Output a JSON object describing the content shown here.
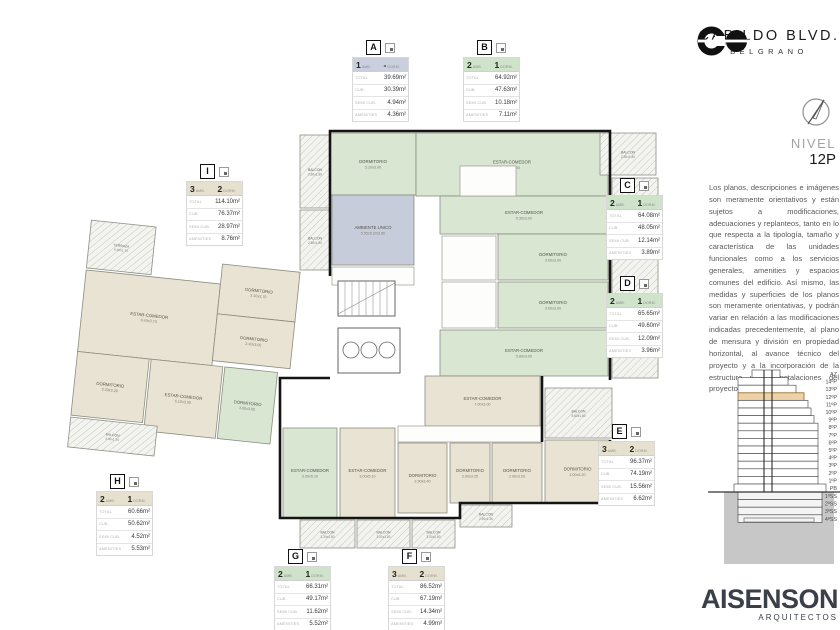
{
  "header": {
    "title": "CABILDO BLVD.",
    "subtitle": "BELGRANO",
    "level_label": "NIVEL",
    "level_value": "12P"
  },
  "disclaimer": "Los planos, descripciones e imágenes son meramente orientativos y están sujetos a modificaciones, adecuaciones y replanteos, tanto en lo que respecta a la tipología, tamaño y característica de las unidades funcionales como a los servicios generales, amenities y espacios comunes del edificio. Así mismo, las medidas y superficies de los planos son meramente orientativas, y podrán variar en relación a las modificaciones indicadas precedentemente, al plano de mensura y división en propiedad horizontal, al avance técnico del proyecto y a la incorporación de la estructura y las instalaciones del proyecto.",
  "architect": {
    "name": "AISENSON",
    "sub": "ARQUITECTOS"
  },
  "colors": {
    "green": "#d9e6d2",
    "beige": "#e8e3d2",
    "blue": "#c7ccdb",
    "header_green": "#cfe2ca",
    "header_beige": "#e6e1cf",
    "header_blue": "#c9cfdd",
    "highlight_floor": "#eed2a6"
  },
  "table_labels": {
    "amb": "AMB.",
    "dorm": "DORM.",
    "rows": [
      "TOTAL",
      "CUB.",
      "SEMI CUB.",
      "AMENITIES"
    ]
  },
  "unit_tables": [
    {
      "letter": "A",
      "amb": "1",
      "dorm": "-",
      "color": "#c9cfdd",
      "values": [
        "39.69m²",
        "30.39m²",
        "4.94m²",
        "4.36m²"
      ]
    },
    {
      "letter": "B",
      "amb": "2",
      "dorm": "1",
      "color": "#cfe2ca",
      "values": [
        "64.92m²",
        "47.63m²",
        "10.18m²",
        "7.11m²"
      ]
    },
    {
      "letter": "C",
      "amb": "2",
      "dorm": "1",
      "color": "#cfe2ca",
      "values": [
        "64.08m²",
        "48.05m²",
        "12.14m²",
        "3.89m²"
      ]
    },
    {
      "letter": "D",
      "amb": "2",
      "dorm": "1",
      "color": "#cfe2ca",
      "values": [
        "65.65m²",
        "49.60m²",
        "12.09m²",
        "3.96m²"
      ]
    },
    {
      "letter": "E",
      "amb": "3",
      "dorm": "2",
      "color": "#e6e1cf",
      "values": [
        "96.37m²",
        "74.19m²",
        "15.56m²",
        "6.62m²"
      ]
    },
    {
      "letter": "F",
      "amb": "3",
      "dorm": "2",
      "color": "#e6e1cf",
      "values": [
        "86.52m²",
        "67.19m²",
        "14.34m²",
        "4.99m²"
      ]
    },
    {
      "letter": "G",
      "amb": "2",
      "dorm": "1",
      "color": "#cfe2ca",
      "values": [
        "66.31m²",
        "49.17m²",
        "11.62m²",
        "5.52m²"
      ]
    },
    {
      "letter": "H",
      "amb": "2",
      "dorm": "1",
      "color": "#e6e1cf",
      "values": [
        "60.66m²",
        "50.62m²",
        "4.52m²",
        "5.53m²"
      ]
    },
    {
      "letter": "I",
      "amb": "3",
      "dorm": "2",
      "color": "#e6e1cf",
      "values": [
        "114.10m²",
        "76.37m²",
        "28.97m²",
        "8.76m²"
      ]
    }
  ],
  "plan": {
    "rooms": [
      {
        "name": "DORMITORIO",
        "dims": "3.10x3.00"
      },
      {
        "name": "ESTAR-COMEDOR",
        "dims": "5.50x3.00"
      },
      {
        "name": "AMBIENTE UNICO",
        "dims": "5.55x5.20/3.50"
      },
      {
        "name": "ESTAR-COMEDOR",
        "dims": "5.30x3.00"
      },
      {
        "name": "DORMITORIO",
        "dims": "3.00x3.00"
      },
      {
        "name": "DORMITORIO",
        "dims": "3.00x3.00"
      },
      {
        "name": "ESTAR-COMEDOR",
        "dims": "5.80x3.00"
      },
      {
        "name": "ESTAR-COMEDOR",
        "dims": "7.00x3.00"
      },
      {
        "name": "DORMITORIO",
        "dims": "2.90x3.20"
      },
      {
        "name": "DORMITORIO",
        "dims": "3.00x3.20"
      },
      {
        "name": "DORMITORIO",
        "dims": "2.90x3.40"
      },
      {
        "name": "DORMITORIO",
        "dims": "2.90x3.25"
      },
      {
        "name": "ESTAR-COMEDOR",
        "dims": "3.00x5.10"
      },
      {
        "name": "ESTAR-COMEDOR",
        "dims": "3.00x5.10"
      },
      {
        "name": "ESTAR-COMEDOR",
        "dims": "6.40x3.70"
      },
      {
        "name": "DORMITORIO",
        "dims": "3.10x2.70"
      },
      {
        "name": "DORMITORIO",
        "dims": "2.40x3.00"
      },
      {
        "name": "DORMITORIO",
        "dims": "3.20x3.20"
      },
      {
        "name": "ESTAR-COMEDOR",
        "dims": "6.10x3.00"
      },
      {
        "name": "DORMITORIO",
        "dims": "3.00x3.00"
      }
    ],
    "balconies": [
      {
        "name": "TERRAZA",
        "dims": "6.40x1.70"
      },
      {
        "name": "BALCON",
        "dims": "2.80x1.80"
      },
      {
        "name": "BALCON",
        "dims": "2.80x1.80"
      },
      {
        "name": "BALCON",
        "dims": "2.80x1.80"
      },
      {
        "name": "BALCON",
        "dims": "6.00x1.80"
      },
      {
        "name": "BALCON",
        "dims": "6.00x1.80"
      },
      {
        "name": "BALCON",
        "dims": "5.80x1.80"
      },
      {
        "name": "BALCON",
        "dims": "3.30x1.80"
      },
      {
        "name": "BALCON",
        "dims": "3.00x1.80"
      },
      {
        "name": "BALCON",
        "dims": "3.00x1.80"
      },
      {
        "name": "BALCON",
        "dims": "2.30x1.30"
      },
      {
        "name": "BALCON",
        "dims": "3.00x1.35"
      }
    ]
  },
  "section": {
    "floors": [
      "AZ",
      "14ºP",
      "13ºP",
      "12ºP",
      "11ºP",
      "10ºP",
      "9ºP",
      "8ºP",
      "7ºP",
      "6ºP",
      "5ºP",
      "4ºP",
      "3ºP",
      "2ºP",
      "1ºP",
      "PB",
      "1ºSS",
      "2ºSS",
      "3ºSS",
      "4ºSS"
    ],
    "highlight": "12ºP"
  }
}
